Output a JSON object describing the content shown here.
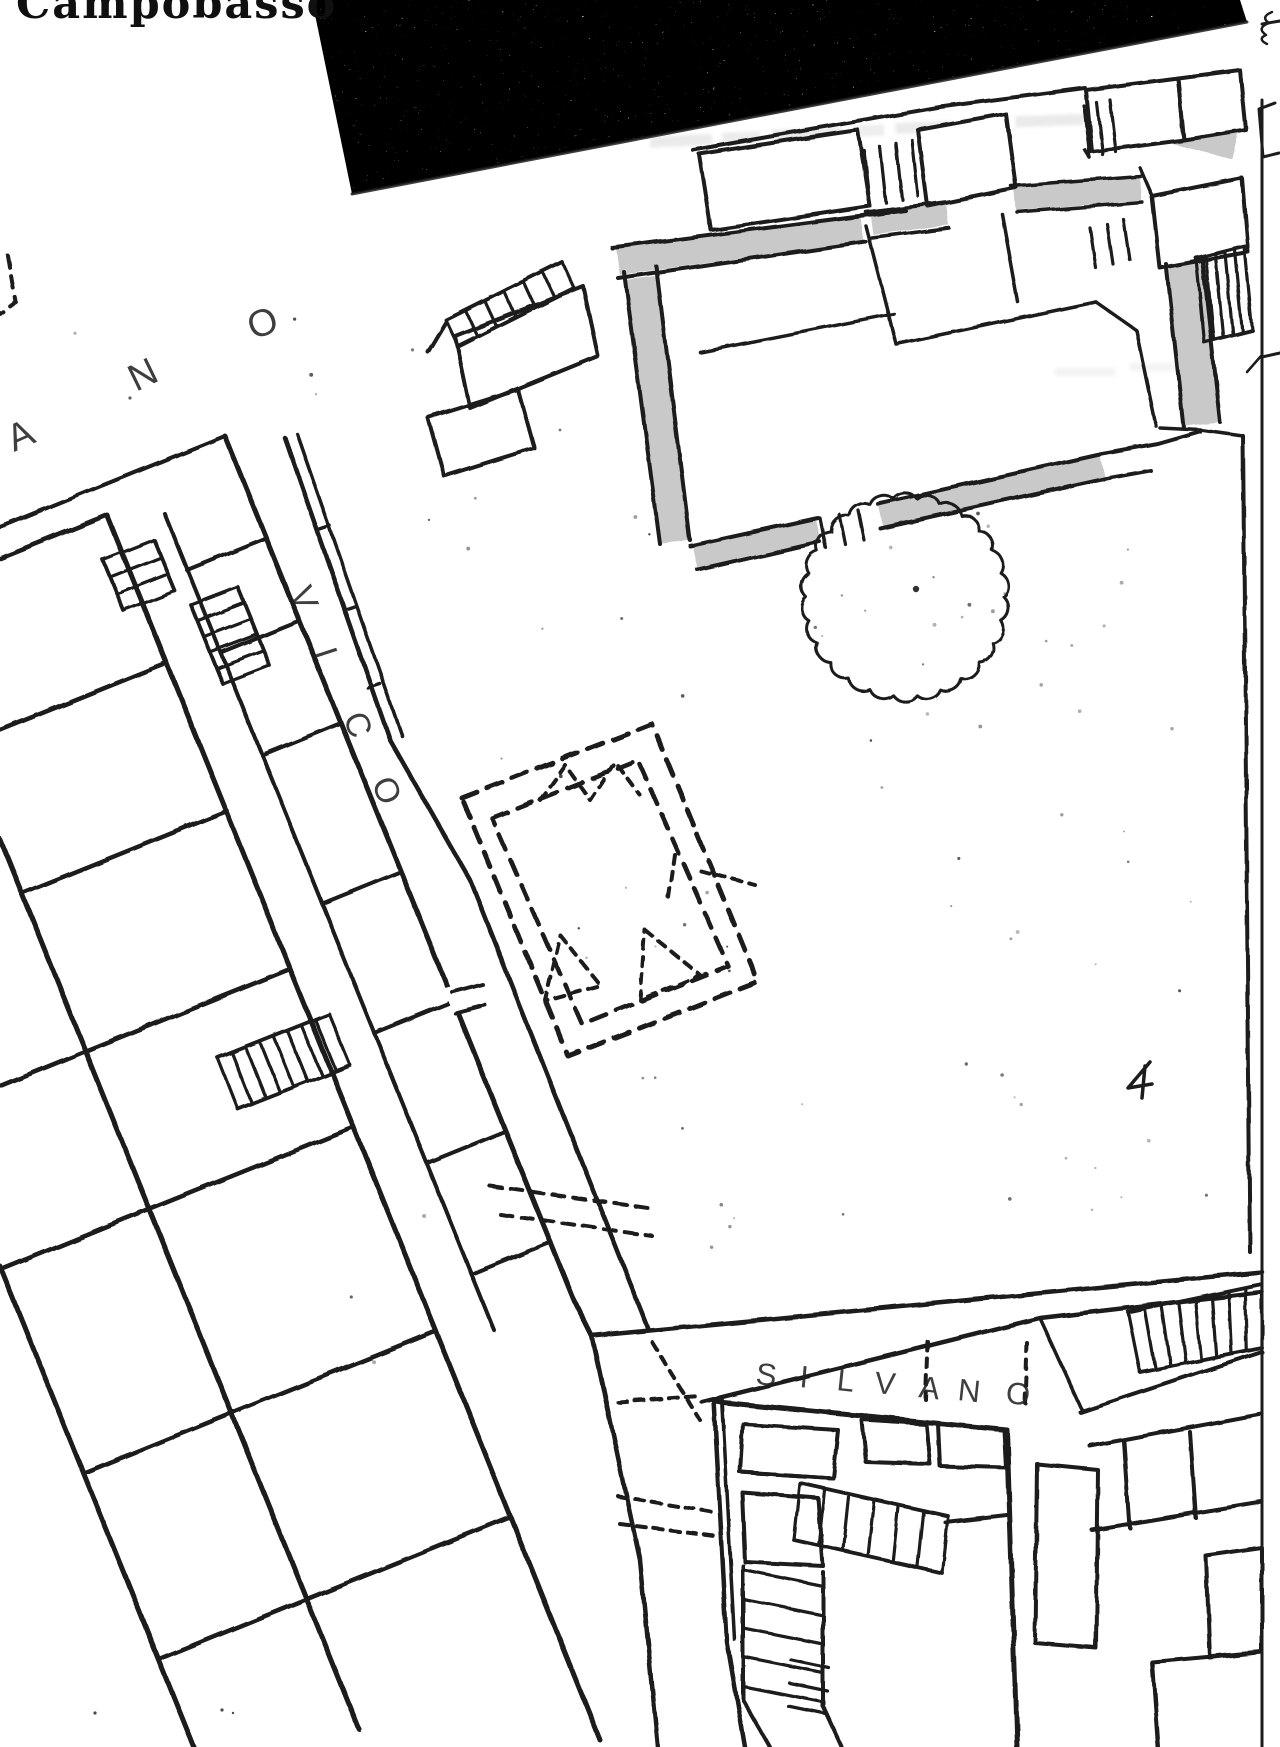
{
  "colors": {
    "paper": "#ffffff",
    "ink": "#1c1c1c",
    "wall_highlight": "#c9c9c9",
    "letter": "#242424"
  },
  "title": {
    "text": "Campobasso"
  },
  "labels": {
    "street_upper": {
      "word": "ANO",
      "letters": [
        "A",
        "N",
        "O"
      ]
    },
    "street_vico": {
      "word": "VICO",
      "letters": [
        "V",
        "I",
        "C",
        "O"
      ]
    },
    "street_silvano": {
      "word": "SILVANO",
      "letters": [
        "S",
        "I",
        "L",
        "V",
        "A",
        "N",
        "O"
      ]
    }
  }
}
